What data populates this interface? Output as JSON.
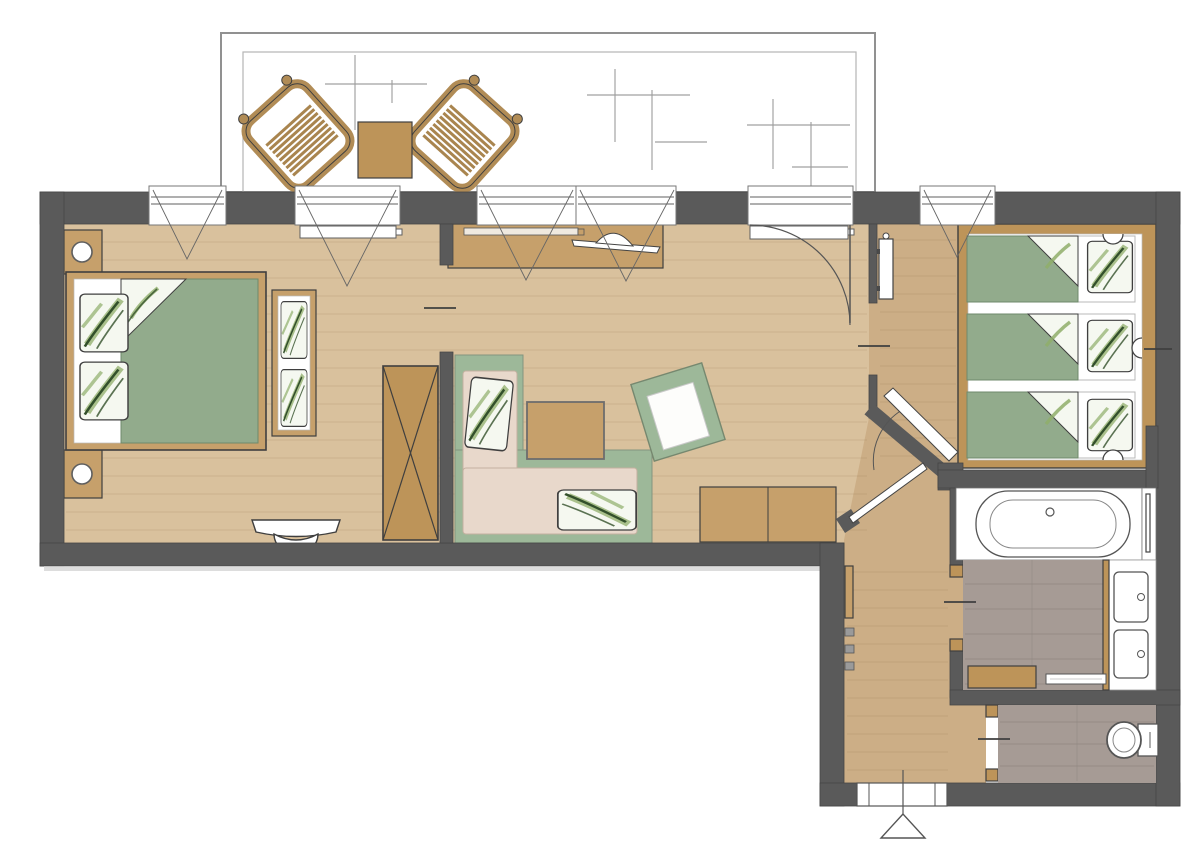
{
  "document": {
    "title": "Apartment floor plan (top view rendering)",
    "type": "2D architectural floor plan",
    "canvas_px": {
      "width": 1200,
      "height": 854
    },
    "visible_text": []
  },
  "palette": {
    "background": "#ffffff",
    "wall": "#5a5a5a",
    "wall_edge": "#454545",
    "floor_wood_main": "#d9c19d",
    "floor_wood_hall": "#ccae86",
    "wood_furniture": "#c6a06b",
    "wood_furniture_dark": "#bd9459",
    "wood_balcony": "#b18c56",
    "duvet_green": "#92ab8c",
    "sofa_green": "#9db899",
    "cushion_beige": "#e8d8cb",
    "pillow_background": "#f5f8f0",
    "fern_dark": "#33502b",
    "fern_light": "#8fae6a",
    "tile_gray": "#a69b95",
    "fixture_white": "#ffffff",
    "line_dark": "#3f3f3f",
    "line_mid": "#5f5f5f",
    "balcony_line": "#919191",
    "tile_mark": "#9e9e9e"
  },
  "rooms": [
    {
      "id": "balcony",
      "label": "Balcony / terrace",
      "items": [
        "lounge-chair",
        "lounge-chair",
        "side-table",
        "tile-layout-marks"
      ]
    },
    {
      "id": "bedroom",
      "label": "Double bedroom",
      "items": [
        "double-bed with green duvet and fern pillows",
        "nightstand with lamp",
        "nightstand with lamp",
        "foot bench with fern pillows",
        "wardrobe (X symbol)",
        "wall console with stool",
        "window radiator"
      ]
    },
    {
      "id": "living-room",
      "label": "Living room",
      "items": [
        "media sideboard with TV",
        "corner sofa with fern pillows",
        "coffee table",
        "armchair",
        "lowboard sideboard",
        "balcony-door radiator"
      ]
    },
    {
      "id": "kids-bedroom",
      "label": "Triple bedroom",
      "items": [
        "bed platform",
        "single mattress ×3 with green duvets and fern pillows",
        "wall lamp ×3"
      ]
    },
    {
      "id": "hallway",
      "label": "Entrance hall",
      "items": [
        "tall mirror cabinet",
        "coat rack strip",
        "coat hooks ×3",
        "entrance door",
        "entrance direction marker"
      ]
    },
    {
      "id": "bathroom",
      "label": "Bathroom",
      "items": [
        "bathtub",
        "towel rail panel",
        "double washbasin vanity",
        "wooden bench",
        "bath mat"
      ]
    },
    {
      "id": "wc",
      "label": "WC",
      "items": [
        "wall-hung toilet"
      ]
    }
  ],
  "openings": {
    "windows_top_wall": 6,
    "balcony_door_with_swing_arc": 1,
    "interior_door_ticks": [
      "bedroom",
      "living-to-hall",
      "bathroom",
      "wc"
    ],
    "diagonal_door_leaves": 2,
    "entrance_door_bottom": 1
  }
}
